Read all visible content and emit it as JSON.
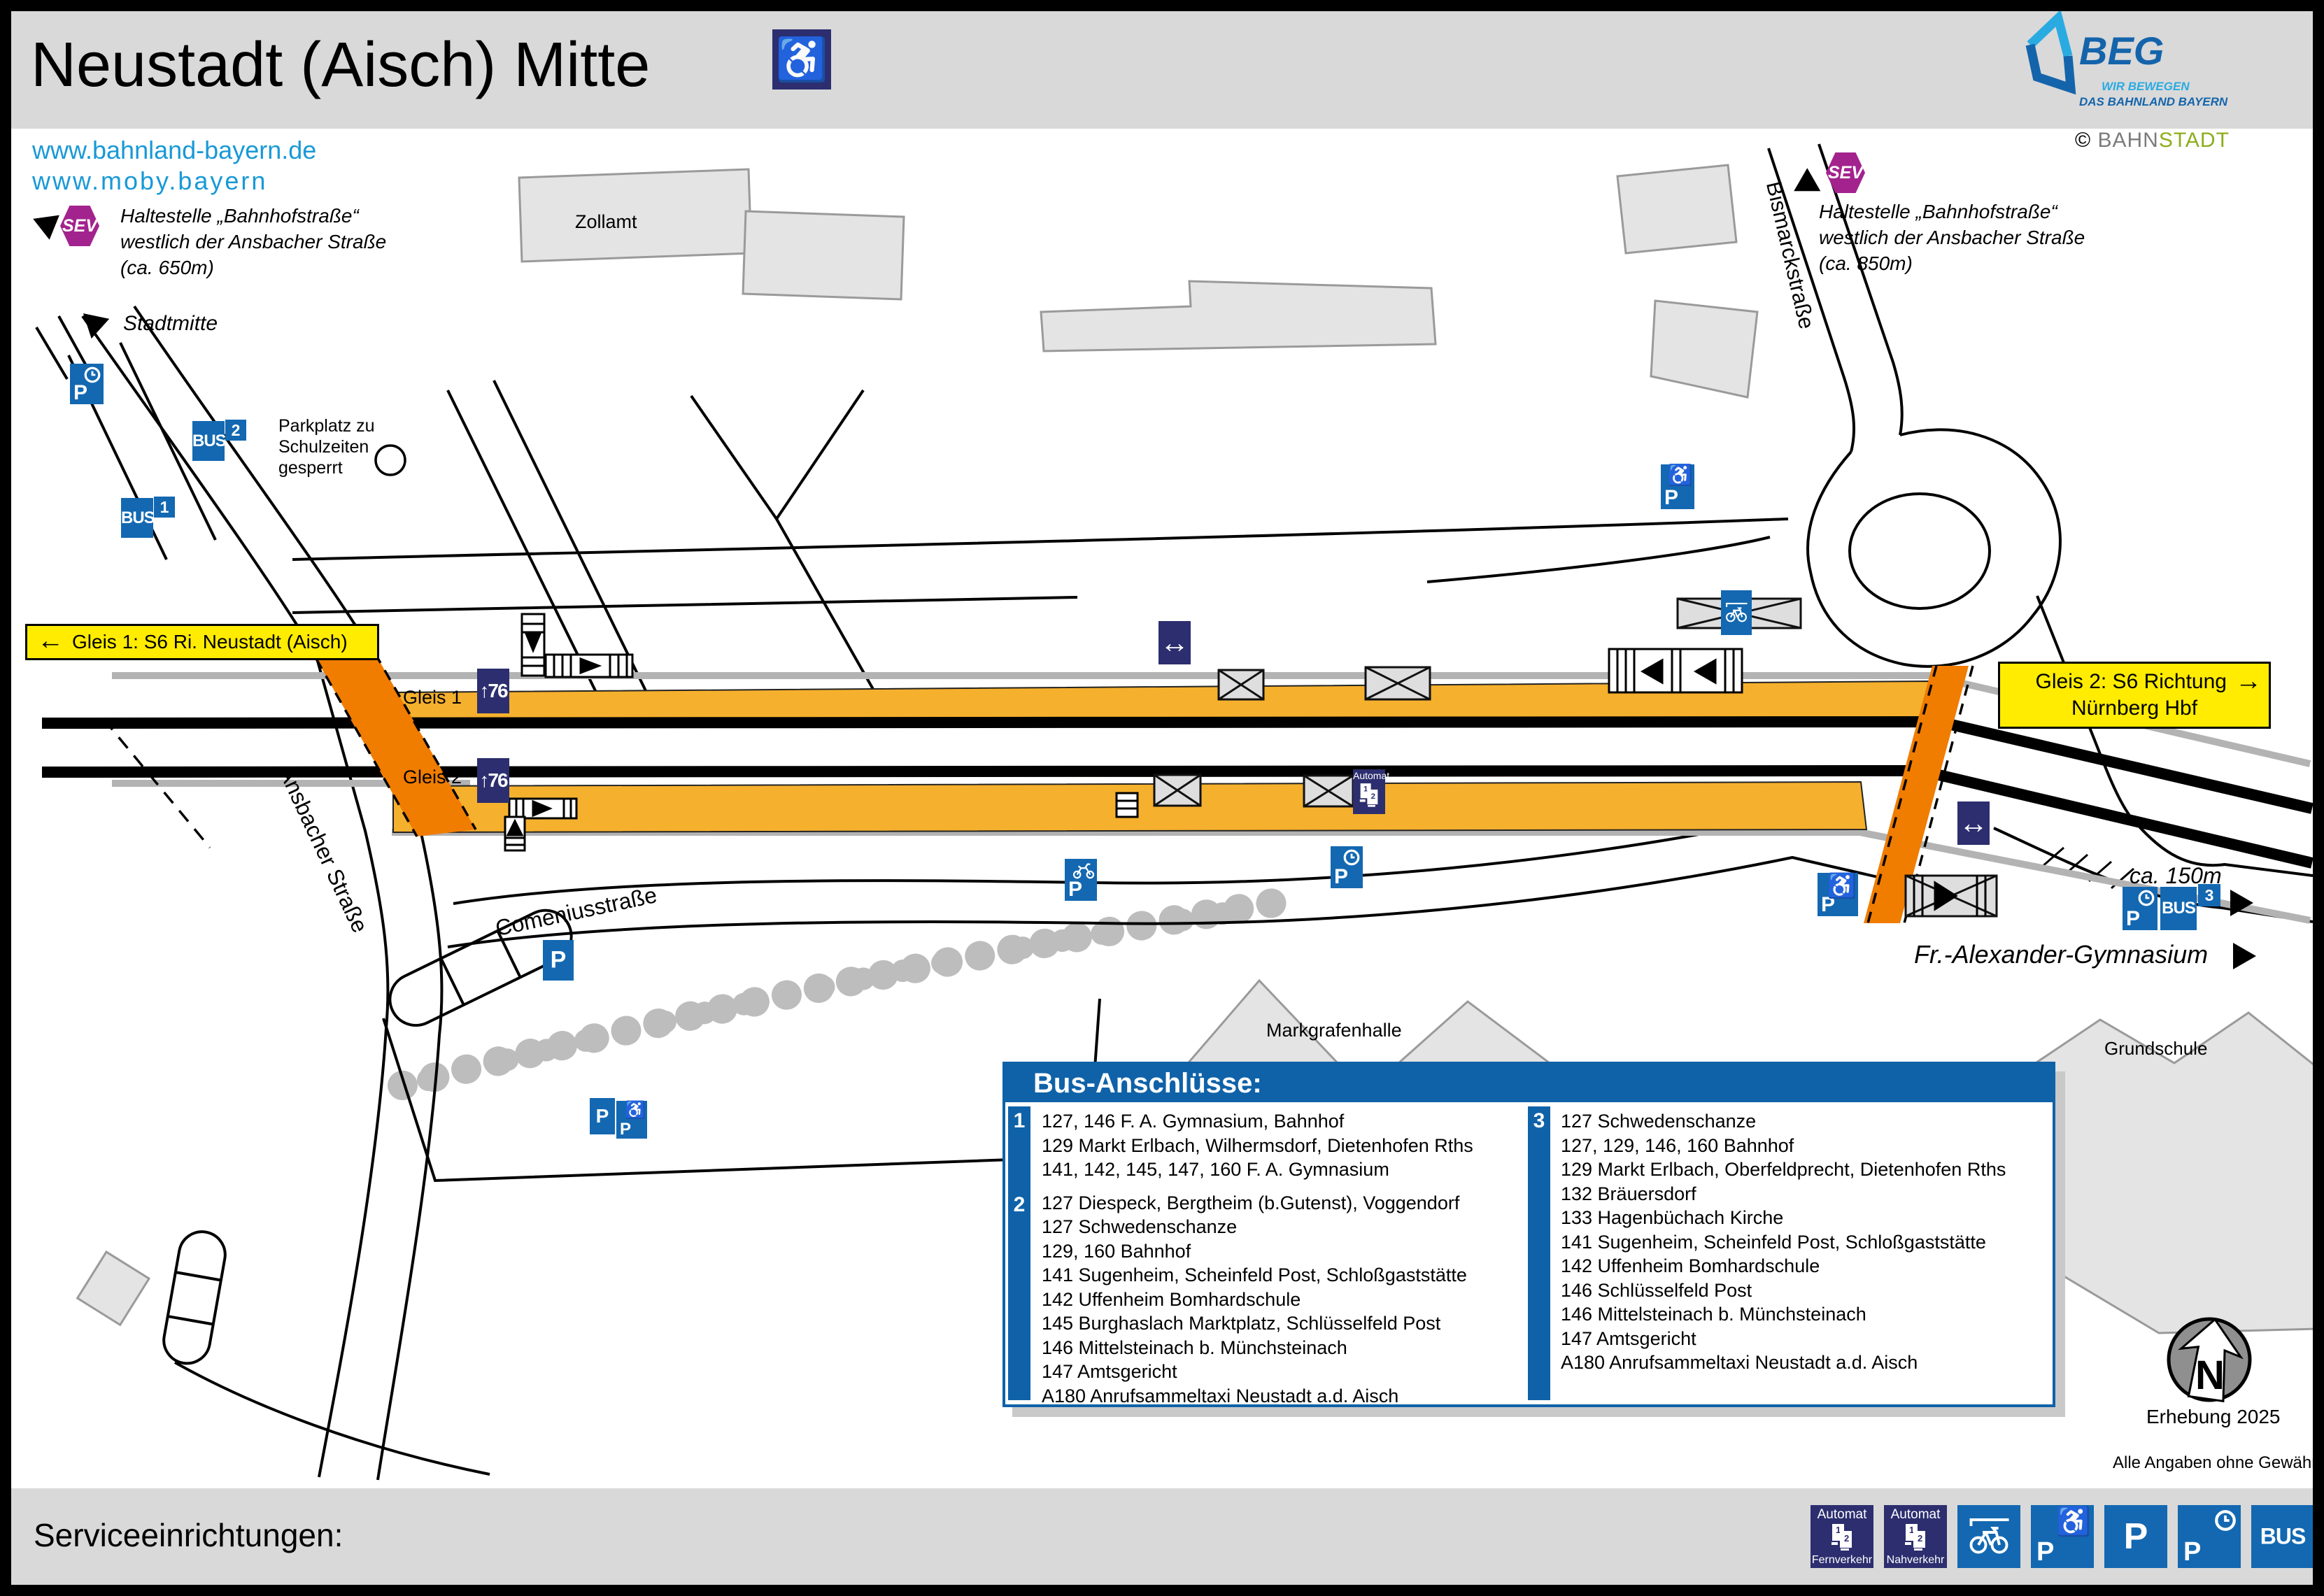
{
  "header": {
    "title": "Neustadt (Aisch) Mitte",
    "beg_name": "BEG",
    "beg_tagline1": "WIR BEWEGEN",
    "beg_tagline2": "DAS BAHNLAND BAYERN",
    "credit_symbol": "©",
    "credit_part1": "BAHN",
    "credit_part2": "STADT"
  },
  "links": {
    "line1": "www.bahnland-bayern.de",
    "line2": "www.moby.bayern"
  },
  "sev_left": {
    "badge": "SEV",
    "line1": "Haltestelle „Bahnhofstraße“",
    "line2": "westlich der Ansbacher Straße",
    "line3": "(ca. 650m)"
  },
  "sev_right": {
    "badge": "SEV",
    "line1": "Haltestelle „Bahnhofstraße“",
    "line2": "westlich der Ansbacher Straße",
    "line3": "(ca. 850m)"
  },
  "map": {
    "stadtmitte": "Stadtmitte",
    "zollamt": "Zollamt",
    "parkplatz_line1": "Parkplatz zu",
    "parkplatz_line2": "Schulzeiten",
    "parkplatz_line3": "gesperrt",
    "bismarckstrasse": "Bismarckstraße",
    "ansbacher_strasse": "Ansbacher Straße",
    "comeniusstrasse": "Comeniusstraße",
    "markgrafenhalle": "Markgrafenhalle",
    "grundschule": "Grundschule",
    "gleis1_label": "Gleis 1",
    "gleis2_label": "Gleis 2",
    "sign_gleis1_arrow": "←",
    "sign_gleis1_text": "Gleis 1: S6 Ri. Neustadt (Aisch)",
    "sign_gleis2_line1": "Gleis 2: S6 Richtung",
    "sign_gleis2_arrow": "→",
    "sign_gleis2_line2": "Nürnberg Hbf",
    "ca150m": "ca. 150m",
    "gymnasium": "Fr.-Alexander-Gymnasium"
  },
  "icons": {
    "p": "P",
    "bus": "BUS",
    "automat": "Automat",
    "fernverkehr": "Fernverkehr",
    "nahverkehr": "Nahverkehr",
    "wheelchair": "♿",
    "arrows": "↔",
    "height76": "↑76",
    "num1": "1",
    "num2": "2",
    "num3": "3",
    "ticket1": "1",
    "ticket2": "2"
  },
  "bus_box": {
    "title": "Bus-Anschlüsse:",
    "groups": [
      {
        "number": "1",
        "lines": [
          "127, 146 F. A. Gymnasium, Bahnhof",
          "129 Markt Erlbach, Wilhermsdorf, Dietenhofen Rths",
          "141, 142, 145, 147, 160 F. A. Gymnasium"
        ]
      },
      {
        "number": "2",
        "lines": [
          "127 Diespeck, Bergtheim (b.Gutenst), Voggendorf",
          "127 Schwedenschanze",
          "129, 160 Bahnhof",
          "141 Sugenheim, Scheinfeld Post, Schloßgaststätte",
          "142 Uffenheim Bomhardschule",
          "145 Burghaslach Marktplatz, Schlüsselfeld Post",
          "146 Mittelsteinach b. Münchsteinach",
          "147 Amtsgericht",
          "A180 Anrufsammeltaxi Neustadt a.d. Aisch"
        ]
      },
      {
        "number": "3",
        "lines": [
          "127 Schwedenschanze",
          "127, 129, 146, 160 Bahnhof",
          "129 Markt Erlbach, Oberfeldprecht, Dietenhofen Rths",
          "132 Bräuersdorf",
          "133 Hagenbüchach Kirche",
          "141 Sugenheim, Scheinfeld Post, Schloßgaststätte",
          "142 Uffenheim Bomhardschule",
          "146 Schlüsselfeld Post",
          "146 Mittelsteinach b. Münchsteinach",
          "147 Amtsgericht",
          "A180 Anrufsammeltaxi Neustadt a.d. Aisch"
        ]
      }
    ]
  },
  "footer": {
    "title": "Serviceeinrichtungen:"
  },
  "notes": {
    "north": "N",
    "erhebung": "Erhebung 2025",
    "disclaimer": "Alle Angaben ohne Gewähr!"
  },
  "colors": {
    "icon_blue": "#1368b1",
    "navy": "#2c2e6f",
    "sev_purple": "#a3238e",
    "platform_orange": "#f5b02e",
    "crossing_orange": "#f07c00",
    "sign_yellow": "#ffec00",
    "header_gray": "#d9d9d9",
    "link_blue": "#1899d6",
    "beg_dark_blue": "#1464ab",
    "beg_light_blue": "#29abe2",
    "bahnstadt_green": "#8dad1c"
  }
}
